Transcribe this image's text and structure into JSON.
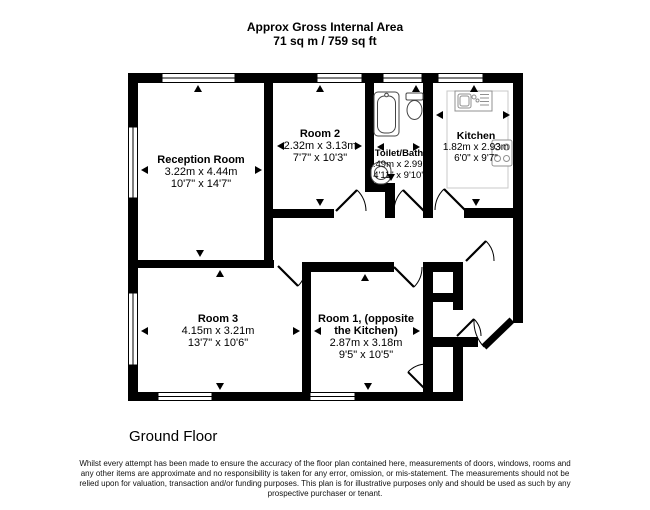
{
  "header": {
    "line1": "Approx Gross Internal Area",
    "line2": "71 sq m / 759 sq ft"
  },
  "rooms": [
    {
      "name": "Reception Room",
      "metric": "3.22m x 4.44m",
      "imperial": "10'7\" x 14'7\""
    },
    {
      "name": "Room 2",
      "metric": "2.32m x 3.13m",
      "imperial": "7'7\" x 10'3\""
    },
    {
      "name": "Toilet/Bath",
      "metric": "1.49m x 2.99m",
      "imperial": "4'11\" x 9'10\""
    },
    {
      "name": "Kitchen",
      "metric": "1.82m x 2.93m",
      "imperial": "6'0\" x 9'7\""
    },
    {
      "name": "Room 3",
      "metric": "4.15m x 3.21m",
      "imperial": "13'7\" x 10'6\""
    },
    {
      "name": "Room 1, (opposite",
      "name2": "the Kitchen)",
      "metric": "2.87m x 3.18m",
      "imperial": "9'5\" x 10'5\""
    }
  ],
  "floor_label": "Ground Floor",
  "disclaimer": {
    "lines": [
      "Whilst every attempt has been made to ensure the accuracy of the floor plan contained here, measurements of doors, windows, rooms and",
      "any other items are approximate and no responsibility is taken for any error, omission, or mis-statement. The measurements should not be",
      "relied upon for valuation, transaction and/or funding purposes. This plan is for illustrative purposes only and should be used as such by any",
      "prospective purchaser or tenant."
    ]
  },
  "fixtures": [
    "bathtub",
    "toilet",
    "basin",
    "kitchen-sink",
    "hob",
    "counter"
  ],
  "colors": {
    "wall": "#000000",
    "background": "#ffffff",
    "fixture_outline": "#444444",
    "kitchen_fixture": "#909090",
    "counter_outline": "#c8c8c8"
  }
}
